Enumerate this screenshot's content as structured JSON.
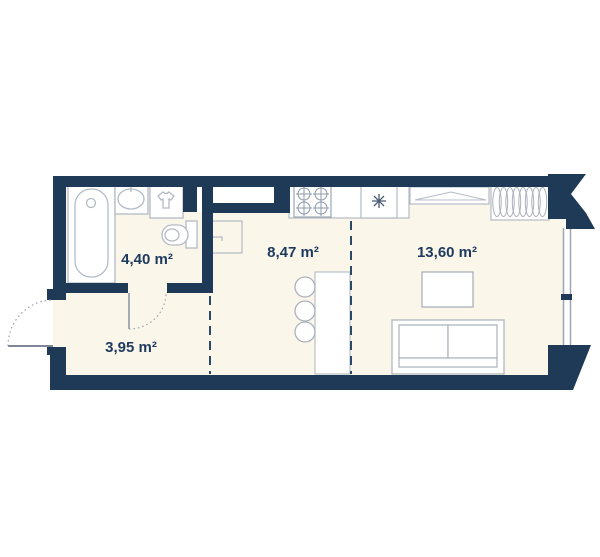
{
  "plan": {
    "rooms": [
      {
        "id": "bathroom",
        "area_label": "4,40 m²"
      },
      {
        "id": "kitchen",
        "area_label": "8,47 m²"
      },
      {
        "id": "living-room",
        "area_label": "13,60 m²"
      },
      {
        "id": "hallway",
        "area_label": "3,95 m²"
      }
    ],
    "fixtures": [
      "bathtub",
      "washbasin",
      "washing-machine",
      "toilet",
      "base-cabinet",
      "ventilation-shaft",
      "kitchen-counter",
      "stove",
      "kitchen-sink",
      "kitchen-island",
      "bar-stool",
      "bar-stool",
      "bar-stool",
      "console-shelf",
      "wardrobe",
      "coffee-table",
      "sofa-bed",
      "window",
      "entrance-door",
      "bathroom-door"
    ],
    "colors": {
      "wall": "#1e3a57",
      "floor": "#fbf6ea",
      "fixture_fill": "#ffffff",
      "fixture_outline": "#b3bac6",
      "label": "#1d3a5e",
      "zone_line": "#2a4a68",
      "door_line": "#8a93a3",
      "background": "#ffffff"
    }
  }
}
